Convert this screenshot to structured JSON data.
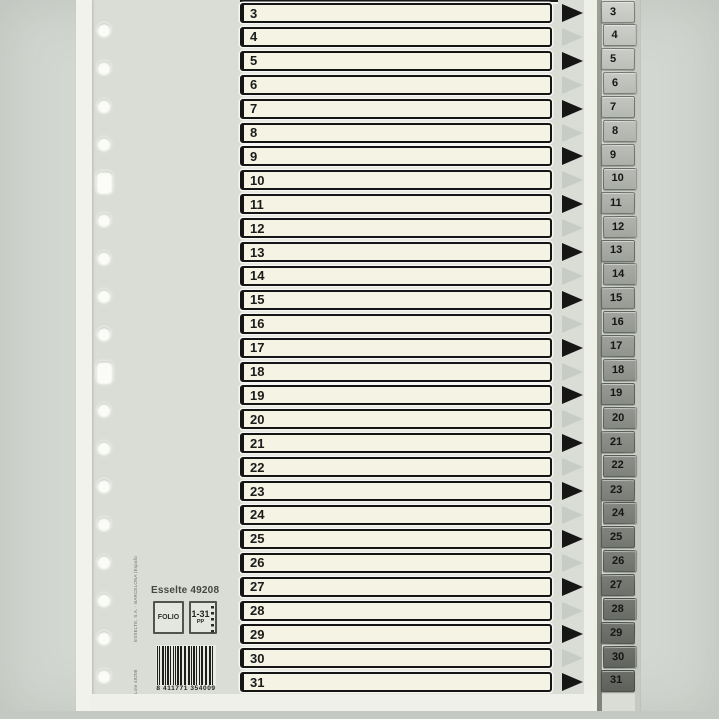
{
  "print": {
    "brand_line": "Esselte 49208",
    "format_label": "FOLIO",
    "range_label": "1-31",
    "range_sub": "PP",
    "barcode_digits": "8 411771 354009",
    "micro_text_top": "ESSELTE, S.A. · BARCELONA (España)",
    "micro_text_bottom": "Lote 49208"
  },
  "divider": {
    "rows": [
      {
        "number": "3",
        "arrow": "black"
      },
      {
        "number": "4",
        "arrow": "gray"
      },
      {
        "number": "5",
        "arrow": "black"
      },
      {
        "number": "6",
        "arrow": "gray"
      },
      {
        "number": "7",
        "arrow": "black"
      },
      {
        "number": "8",
        "arrow": "gray"
      },
      {
        "number": "9",
        "arrow": "black"
      },
      {
        "number": "10",
        "arrow": "gray"
      },
      {
        "number": "11",
        "arrow": "black"
      },
      {
        "number": "12",
        "arrow": "gray"
      },
      {
        "number": "13",
        "arrow": "black"
      },
      {
        "number": "14",
        "arrow": "gray"
      },
      {
        "number": "15",
        "arrow": "black"
      },
      {
        "number": "16",
        "arrow": "gray"
      },
      {
        "number": "17",
        "arrow": "black"
      },
      {
        "number": "18",
        "arrow": "gray"
      },
      {
        "number": "19",
        "arrow": "black"
      },
      {
        "number": "20",
        "arrow": "gray"
      },
      {
        "number": "21",
        "arrow": "black"
      },
      {
        "number": "22",
        "arrow": "gray"
      },
      {
        "number": "23",
        "arrow": "black"
      },
      {
        "number": "24",
        "arrow": "gray"
      },
      {
        "number": "25",
        "arrow": "black"
      },
      {
        "number": "26",
        "arrow": "gray"
      },
      {
        "number": "27",
        "arrow": "black"
      },
      {
        "number": "28",
        "arrow": "gray"
      },
      {
        "number": "29",
        "arrow": "black"
      },
      {
        "number": "30",
        "arrow": "gray"
      },
      {
        "number": "31",
        "arrow": "black"
      }
    ],
    "tabs": [
      "3",
      "4",
      "5",
      "6",
      "7",
      "8",
      "9",
      "10",
      "11",
      "12",
      "13",
      "14",
      "15",
      "16",
      "17",
      "18",
      "19",
      "20",
      "21",
      "22",
      "23",
      "24",
      "25",
      "26",
      "27",
      "28",
      "29",
      "30",
      "31"
    ]
  },
  "colors": {
    "background": "#d3d7d1",
    "sheet": "#d9ddd5",
    "entry_fill": "#f4f3e4",
    "entry_border": "#151515",
    "arrow_black": "#161616",
    "arrow_gray": "#c7ccc4",
    "tab_light": "#d0d4cc",
    "tab_dark": "#6b6f65"
  }
}
